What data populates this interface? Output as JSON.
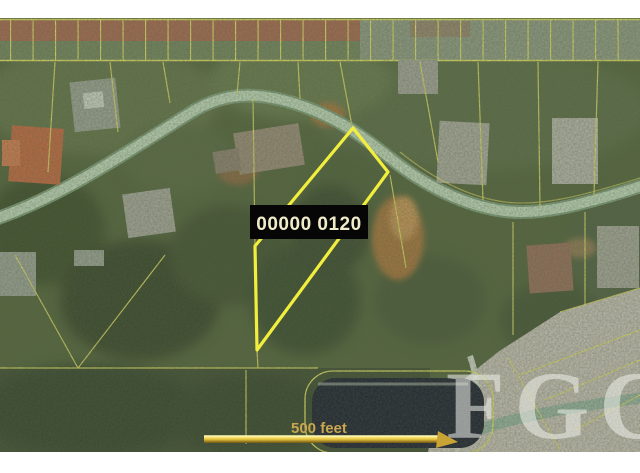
{
  "map": {
    "parcel_label": "00000 0120",
    "scale_bar": {
      "label": "500 feet"
    },
    "watermark_text": "FGC",
    "colors": {
      "highlight_parcel": "#f2ee3e",
      "parcel_line": "#ddd966",
      "road": "#bdd2b6",
      "label_background": "#060606",
      "label_text": "#f0ecca",
      "scale_text": "#c9a64f",
      "scale_bar_gold": "#e9c63f",
      "pond": "#232634"
    }
  }
}
